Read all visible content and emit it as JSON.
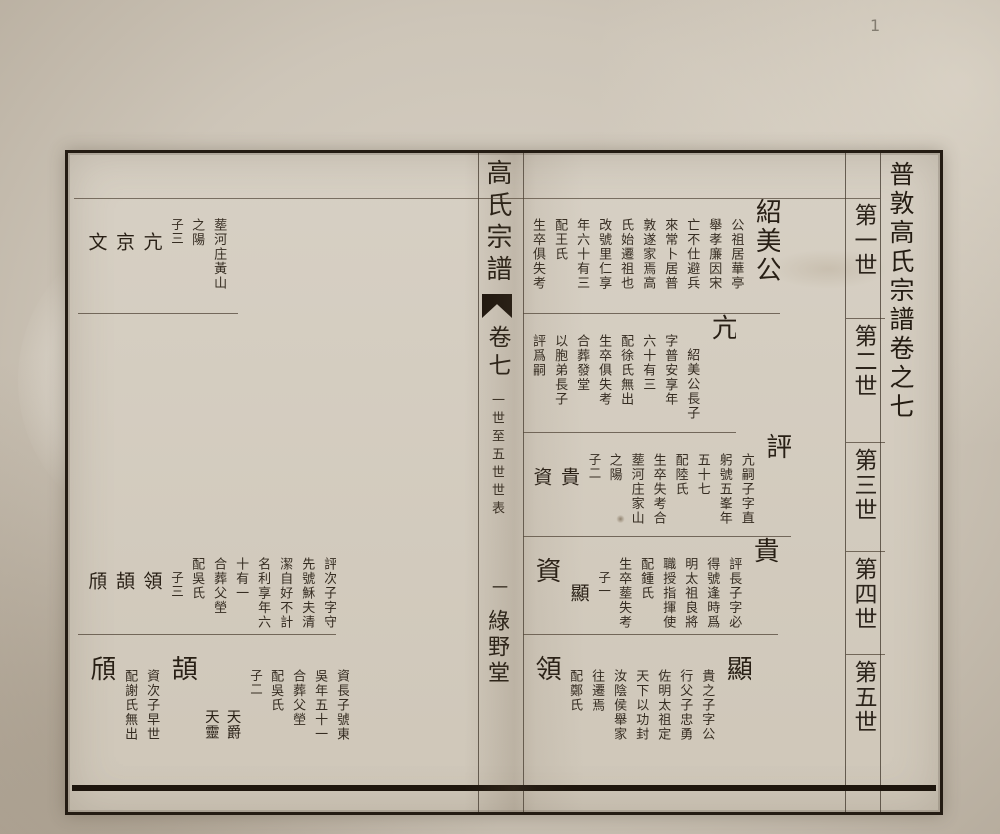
{
  "photo": {
    "corner_mark": "1"
  },
  "book": {
    "margin_title": "普敦高氏宗譜卷之七",
    "generation_labels": [
      "第一世",
      "第二世",
      "第三世",
      "第四世",
      "第五世"
    ],
    "banxin": {
      "title": "高氏宗譜",
      "volume": "卷七",
      "section": "一世至五世世表",
      "page_number": "一",
      "hall_name": "綠野堂"
    },
    "right_page": {
      "bands": [
        {
          "columns": [
            {
              "kind": "name",
              "ofs": 0,
              "text": "紹美公"
            },
            {
              "kind": "bio",
              "ofs": 1,
              "text": "公祖居華亭"
            },
            {
              "kind": "bio",
              "ofs": 1,
              "text": "舉孝廉因宋"
            },
            {
              "kind": "bio",
              "ofs": 1,
              "text": "亡不仕避兵"
            },
            {
              "kind": "bio",
              "ofs": 1,
              "text": "來常卜居普"
            },
            {
              "kind": "bio",
              "ofs": 1,
              "text": "敦遂家焉高"
            },
            {
              "kind": "bio",
              "ofs": 1,
              "text": "氏始遷祖也"
            },
            {
              "kind": "bio",
              "ofs": 1,
              "text": "改號里仁享"
            },
            {
              "kind": "bio",
              "ofs": 1,
              "text": "年六十有三"
            },
            {
              "kind": "bio",
              "ofs": 1,
              "text": "配王氏"
            },
            {
              "kind": "bio",
              "ofs": 1,
              "text": "生卒俱失考"
            }
          ]
        },
        {
          "columns": [
            {
              "kind": "name",
              "ofs": 0,
              "text": "亢"
            },
            {
              "kind": "bio",
              "ofs": 2,
              "text": "紹美公長子"
            },
            {
              "kind": "bio",
              "ofs": 1,
              "text": "字普安享年"
            },
            {
              "kind": "bio",
              "ofs": 1,
              "text": "六十有三"
            },
            {
              "kind": "bio",
              "ofs": 1,
              "text": "配徐氏無出"
            },
            {
              "kind": "bio",
              "ofs": 1,
              "text": "生卒俱失考"
            },
            {
              "kind": "bio",
              "ofs": 1,
              "text": "合葬發堂"
            },
            {
              "kind": "bio",
              "ofs": 1,
              "text": "以胞弟長子"
            },
            {
              "kind": "bio",
              "ofs": 1,
              "text": "評爲嗣"
            }
          ]
        },
        {
          "columns": [
            {
              "kind": "name",
              "ofs": 0,
              "text": "評"
            },
            {
              "kind": "bio",
              "ofs": 1,
              "text": "亢嗣子字直"
            },
            {
              "kind": "bio",
              "ofs": 1,
              "text": "躬號五峯年"
            },
            {
              "kind": "bio",
              "ofs": 1,
              "text": "五十七"
            },
            {
              "kind": "bio",
              "ofs": 1,
              "text": "配陸氏"
            },
            {
              "kind": "bio",
              "ofs": 1,
              "text": "生卒失考合"
            },
            {
              "kind": "bio",
              "ofs": 1,
              "text": "塟河庄家山"
            },
            {
              "kind": "bio",
              "ofs": 1,
              "text": "之陽"
            },
            {
              "kind": "note",
              "ofs": 1,
              "text": "子二"
            },
            {
              "kind": "kid",
              "ofs": 2,
              "text": "貴"
            },
            {
              "kind": "kid",
              "ofs": 2,
              "text": "資"
            }
          ]
        },
        {
          "columns": [
            {
              "kind": "name",
              "ofs": 0,
              "text": "貴"
            },
            {
              "kind": "bio",
              "ofs": 1,
              "text": "評長子字必"
            },
            {
              "kind": "bio",
              "ofs": 1,
              "text": "得號逢時爲"
            },
            {
              "kind": "bio",
              "ofs": 1,
              "text": "明太祖良將"
            },
            {
              "kind": "bio",
              "ofs": 1,
              "text": "職授指揮使"
            },
            {
              "kind": "bio",
              "ofs": 1,
              "text": "配鍾氏"
            },
            {
              "kind": "bio",
              "ofs": 1,
              "text": "生卒塟失考"
            },
            {
              "kind": "note",
              "ofs": 2,
              "text": "子一"
            },
            {
              "kind": "kid",
              "ofs": 3,
              "text": "顯"
            },
            {
              "kind": "name",
              "ofs": 1,
              "text": "資"
            }
          ]
        },
        {
          "columns": [
            {
              "kind": "name",
              "ofs": 1,
              "text": "顯"
            },
            {
              "kind": "bio",
              "ofs": 2,
              "text": "貴之子字公"
            },
            {
              "kind": "bio",
              "ofs": 2,
              "text": "行父子忠勇"
            },
            {
              "kind": "bio",
              "ofs": 2,
              "text": "佐明太祖定"
            },
            {
              "kind": "bio",
              "ofs": 2,
              "text": "天下以功封"
            },
            {
              "kind": "bio",
              "ofs": 2,
              "text": "汝陰侯舉家"
            },
            {
              "kind": "bio",
              "ofs": 2,
              "text": "往遷焉"
            },
            {
              "kind": "bio",
              "ofs": 2,
              "text": "配鄭氏"
            },
            {
              "kind": "name",
              "ofs": 1,
              "text": "領"
            }
          ]
        }
      ]
    },
    "left_page": {
      "bands": [
        {
          "inset": 12,
          "columns": [
            {
              "kind": "bio",
              "ofs": 1,
              "text": "塟河庄黃山"
            },
            {
              "kind": "bio",
              "ofs": 1,
              "text": "之陽"
            },
            {
              "kind": "note",
              "ofs": 1,
              "text": "子三"
            },
            {
              "kind": "kid",
              "ofs": 2,
              "text": "亢"
            },
            {
              "kind": "kid",
              "ofs": 2,
              "text": "京"
            },
            {
              "kind": "kid",
              "ofs": 2,
              "text": "文"
            }
          ]
        },
        {
          "columns": []
        },
        {
          "columns": []
        },
        {
          "columns": [
            {
              "kind": "bio",
              "ofs": 1,
              "text": "評次子字守"
            },
            {
              "kind": "bio",
              "ofs": 1,
              "text": "先號穌夫清"
            },
            {
              "kind": "bio",
              "ofs": 1,
              "text": "潔自好不計"
            },
            {
              "kind": "bio",
              "ofs": 1,
              "text": "名利享年六"
            },
            {
              "kind": "bio",
              "ofs": 1,
              "text": "十有一"
            },
            {
              "kind": "bio",
              "ofs": 1,
              "text": "合葬父塋"
            },
            {
              "kind": "bio",
              "ofs": 1,
              "text": "配吳氏"
            },
            {
              "kind": "note",
              "ofs": 2,
              "text": "子三"
            },
            {
              "kind": "kid",
              "ofs": 2,
              "text": "領"
            },
            {
              "kind": "kid",
              "ofs": 2,
              "text": "頡"
            },
            {
              "kind": "kid",
              "ofs": 2,
              "text": "頎"
            }
          ]
        },
        {
          "columns": [
            {
              "kind": "bio",
              "ofs": 2,
              "text": "資長子號東"
            },
            {
              "kind": "bio",
              "ofs": 2,
              "text": "吳年五十一"
            },
            {
              "kind": "bio",
              "ofs": 2,
              "text": "合葬父塋"
            },
            {
              "kind": "bio",
              "ofs": 2,
              "text": "配吳氏"
            },
            {
              "kind": "note",
              "ofs": 2,
              "text": "子二"
            },
            {
              "kind": "kid-sm",
              "ofs": 4,
              "text": "天爵"
            },
            {
              "kind": "kid-sm",
              "ofs": 4,
              "text": "天靈"
            },
            {
              "kind": "name",
              "ofs": 1,
              "text": "頡"
            },
            {
              "kind": "bio",
              "ofs": 2,
              "text": "資次子早世"
            },
            {
              "kind": "bio",
              "ofs": 2,
              "text": "配謝氏無出"
            },
            {
              "kind": "name",
              "ofs": 1,
              "text": "頎"
            }
          ]
        }
      ]
    }
  }
}
